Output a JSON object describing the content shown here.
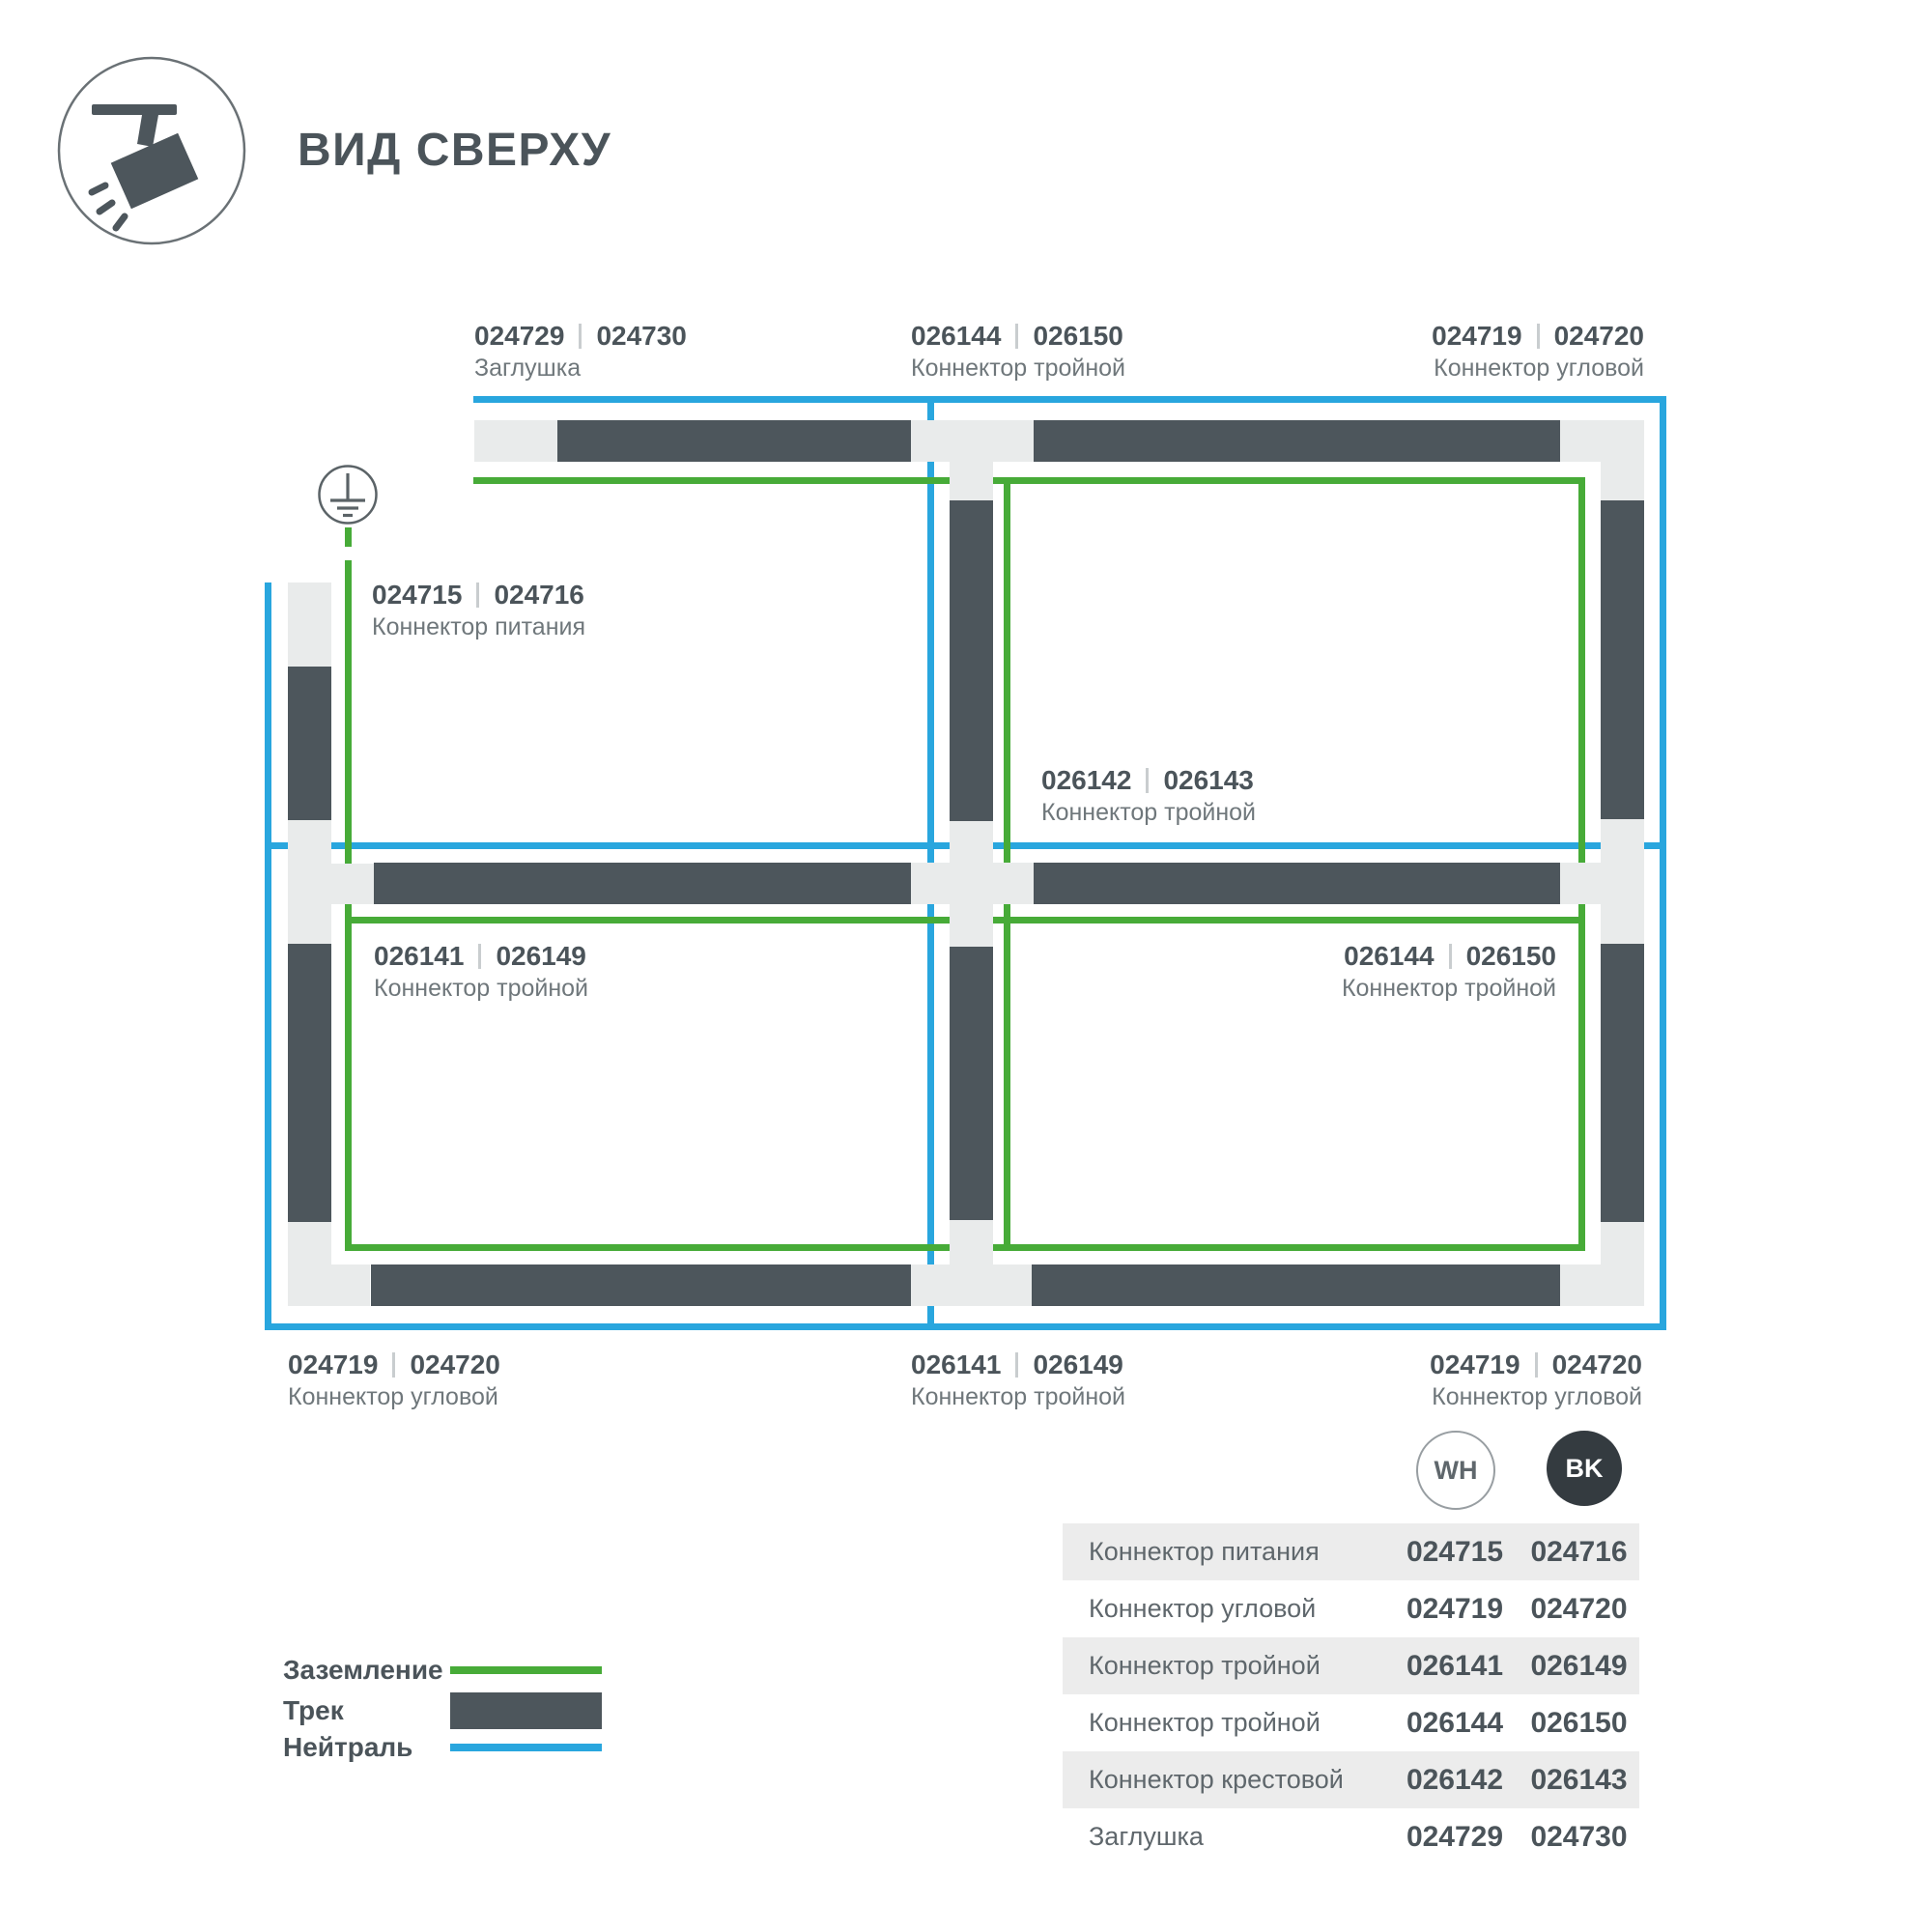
{
  "header": {
    "title": "ВИД СВЕРХУ",
    "icon": "track-spotlight-top-view-icon"
  },
  "colors": {
    "track": "#4d565c",
    "connector": "#e9ebeb",
    "neutral": "#29a6de",
    "ground": "#47ab38",
    "text_dark": "#4b545a",
    "text_gray": "#6f777b",
    "table_band": "#ececec",
    "bk_badge": "#343b40"
  },
  "labels": [
    {
      "wh": "024729",
      "bk": "024730",
      "caption": "Заглушка"
    },
    {
      "wh": "026144",
      "bk": "026150",
      "caption": "Коннектор тройной"
    },
    {
      "wh": "024719",
      "bk": "024720",
      "caption": "Коннектор угловой"
    },
    {
      "wh": "024715",
      "bk": "024716",
      "caption": "Коннектор питания"
    },
    {
      "wh": "026142",
      "bk": "026143",
      "caption": "Коннектор тройной"
    },
    {
      "wh": "026141",
      "bk": "026149",
      "caption": "Коннектор тройной"
    },
    {
      "wh": "026144",
      "bk": "026150",
      "caption": "Коннектор тройной"
    },
    {
      "wh": "024719",
      "bk": "024720",
      "caption": "Коннектор угловой"
    },
    {
      "wh": "026141",
      "bk": "026149",
      "caption": "Коннектор тройной"
    },
    {
      "wh": "024719",
      "bk": "024720",
      "caption": "Коннектор угловой"
    }
  ],
  "badges": {
    "white": "WH",
    "black": "BK"
  },
  "table": {
    "rows": [
      {
        "name": "Коннектор питания",
        "wh": "024715",
        "bk": "024716"
      },
      {
        "name": "Коннектор угловой",
        "wh": "024719",
        "bk": "024720"
      },
      {
        "name": "Коннектор тройной",
        "wh": "026141",
        "bk": "026149"
      },
      {
        "name": "Коннектор тройной",
        "wh": "026144",
        "bk": "026150"
      },
      {
        "name": "Коннектор крестовой",
        "wh": "026142",
        "bk": "026143"
      },
      {
        "name": "Заглушка",
        "wh": "024729",
        "bk": "024730"
      }
    ]
  },
  "legend": {
    "items": [
      {
        "label": "Заземление",
        "swatch": "ground-line"
      },
      {
        "label": "Трек",
        "swatch": "track-bar"
      },
      {
        "label": "Нейтраль",
        "swatch": "neutral-line"
      }
    ]
  }
}
